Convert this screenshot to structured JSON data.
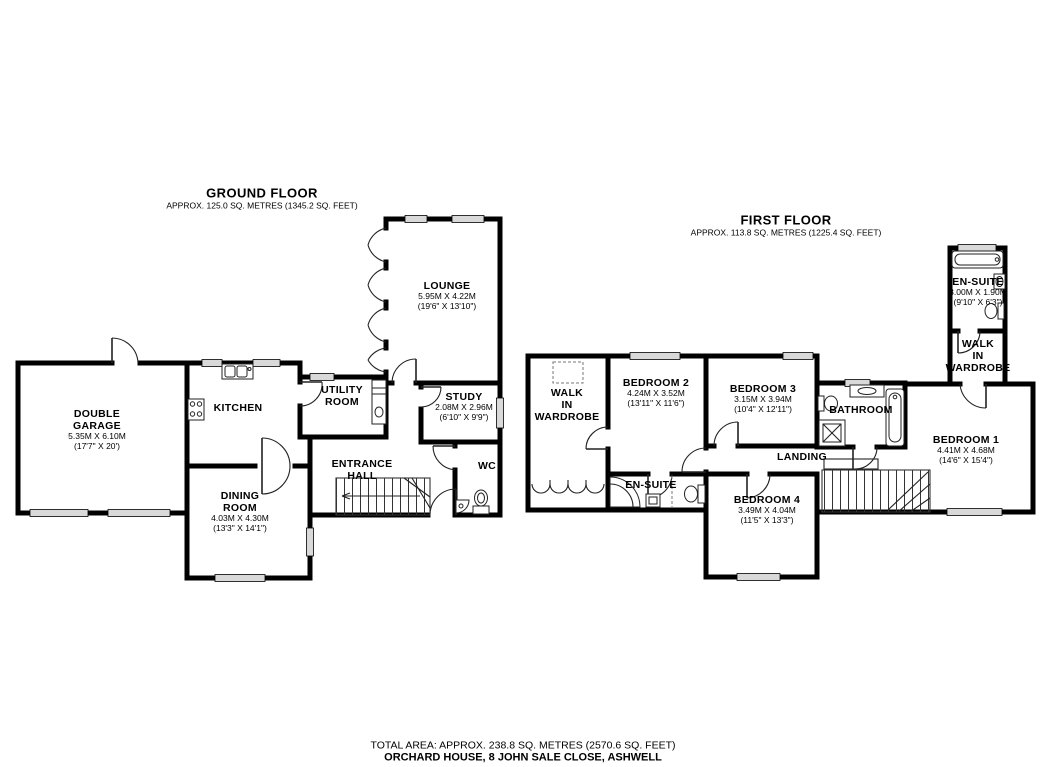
{
  "colors": {
    "wall": "#000000",
    "window_fill": "#d9d9d9",
    "background": "#ffffff"
  },
  "ground_floor": {
    "title": "GROUND FLOOR",
    "subtitle": "APPROX. 125.0 SQ. METRES (1345.2 SQ. FEET)",
    "rooms": {
      "double_garage": {
        "name": [
          "DOUBLE",
          "GARAGE"
        ],
        "metric": "5.35M X 6.10M",
        "imperial": "(17'7\" X 20')"
      },
      "kitchen": {
        "name": "KITCHEN"
      },
      "utility_room": {
        "name": [
          "UTILITY",
          "ROOM"
        ]
      },
      "lounge": {
        "name": "LOUNGE",
        "metric": "5.95M X 4.22M",
        "imperial": "(19'6\" X 13'10\")"
      },
      "study": {
        "name": "STUDY",
        "metric": "2.08M X 2.96M",
        "imperial": "(6'10\" X 9'9\")"
      },
      "entrance_hall": {
        "name": [
          "ENTRANCE",
          "HALL"
        ]
      },
      "dining_room": {
        "name": [
          "DINING",
          "ROOM"
        ],
        "metric": "4.03M X 4.30M",
        "imperial": "(13'3\" X 14'1\")"
      },
      "wc": {
        "name": "WC"
      }
    }
  },
  "first_floor": {
    "title": "FIRST FLOOR",
    "subtitle": "APPROX. 113.8 SQ. METRES (1225.4 SQ. FEET)",
    "rooms": {
      "walk_in_wardrobe_left": {
        "name": [
          "WALK",
          "IN",
          "WARDROBE"
        ]
      },
      "bedroom_2": {
        "name": "BEDROOM 2",
        "metric": "4.24M X 3.52M",
        "imperial": "(13'11\" X 11'6\")"
      },
      "bedroom_3": {
        "name": "BEDROOM 3",
        "metric": "3.15M X 3.94M",
        "imperial": "(10'4\" X 12'11\")"
      },
      "bathroom": {
        "name": "BATHROOM"
      },
      "bedroom_1": {
        "name": "BEDROOM 1",
        "metric": "4.41M X 4.68M",
        "imperial": "(14'6\" X 15'4\")"
      },
      "en_suite_master": {
        "name": "EN-SUITE",
        "metric": "3.00M X 1.90M",
        "imperial": "(9'10\" X 6'3\")"
      },
      "walk_in_wardrobe_right": {
        "name": [
          "WALK",
          "IN",
          "WARDROBE"
        ]
      },
      "landing": {
        "name": "LANDING"
      },
      "en_suite": {
        "name": "EN-SUITE"
      },
      "bedroom_4": {
        "name": "BEDROOM 4",
        "metric": "3.49M X 4.04M",
        "imperial": "(11'5\" X 13'3\")"
      }
    }
  },
  "footer": {
    "total_area": "TOTAL AREA: APPROX. 238.8 SQ. METRES (2570.6 SQ. FEET)",
    "address": "ORCHARD HOUSE, 8 JOHN SALE CLOSE, ASHWELL"
  }
}
